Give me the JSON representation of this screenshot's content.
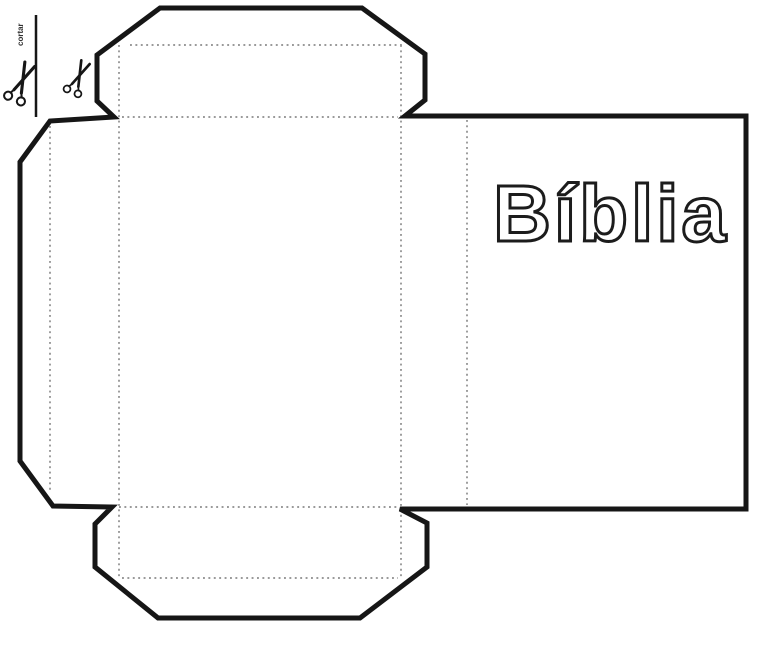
{
  "labels": {
    "cover_title": "Bíblia",
    "cut": "cortar"
  },
  "icons": {
    "scissors": "✂"
  },
  "colors": {
    "background": "#ffffff",
    "cut_line": "#161616",
    "fold_line": "#9a9a9a",
    "title_outline": "#1c1c1c",
    "title_fill": "#ffffff",
    "cut_label_color": "#333333"
  }
}
